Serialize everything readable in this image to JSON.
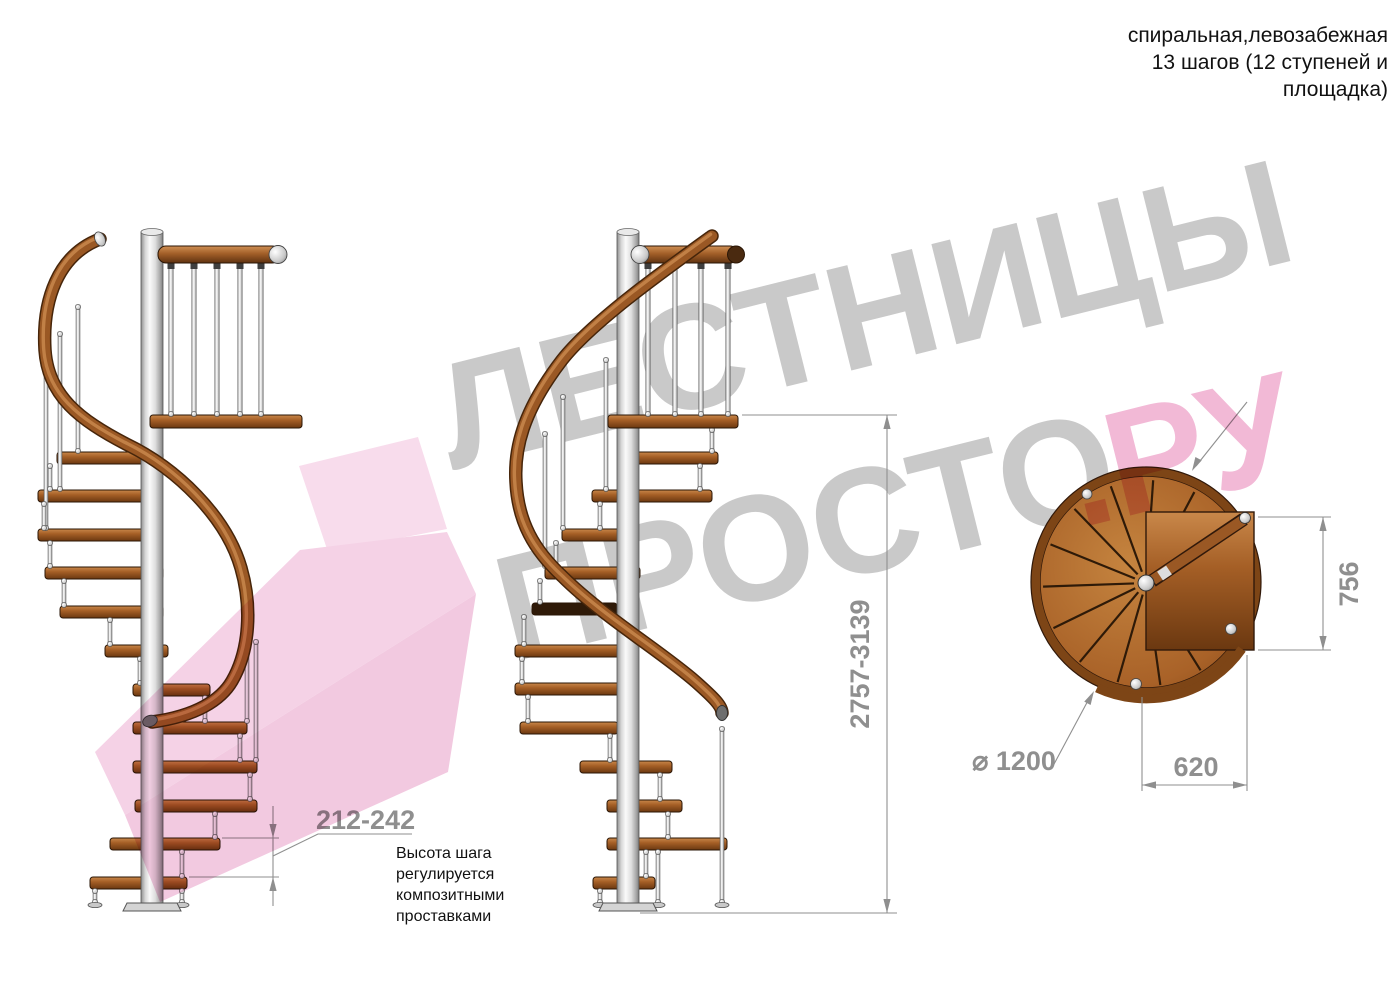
{
  "header": {
    "line1": "спиральная,левозабежная",
    "line2": "13 шагов (12 ступеней и",
    "line3": "площадка)"
  },
  "watermark": {
    "word1": "ЛЕСТНИЦЫ",
    "word2": "ПРОСТО",
    "word3": ".РУ"
  },
  "dims": {
    "total_height": "2757-3139",
    "step_pitch": "212-242",
    "plan_depth": "756",
    "plan_width": "620",
    "plan_diameter": "⌀ 1200"
  },
  "note": {
    "line1": "Высота шага",
    "line2": "регулируется",
    "line3": "композитными",
    "line4": "проставками"
  },
  "colors": {
    "wood_mid": "#a55f26",
    "wood_light": "#c9884a",
    "wood_dark": "#6b3810",
    "rail_outline": "#46250a",
    "metal_light": "#f5f5f5",
    "metal_dark": "#8f8f8f",
    "dim_gray": "#8f8f8f",
    "watermark_gray": "#c9c9c9",
    "watermark_pink": "#f2b9d6",
    "text_black": "#111111"
  }
}
